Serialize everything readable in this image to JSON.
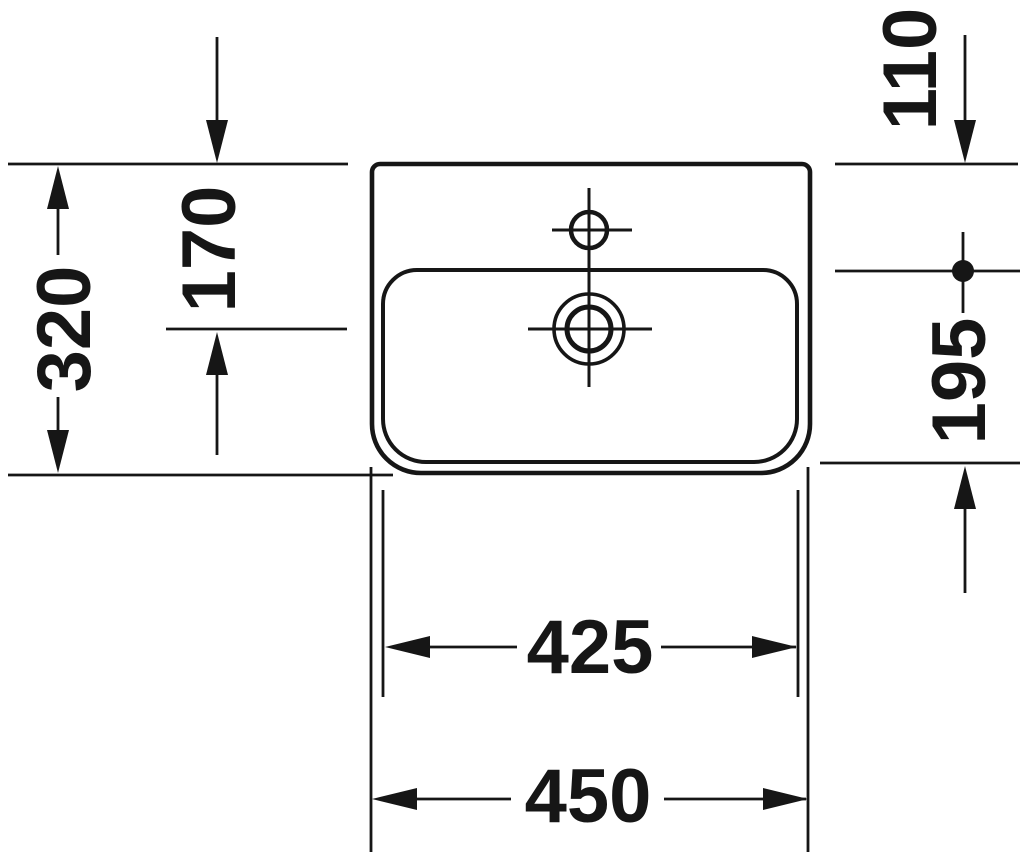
{
  "figure": {
    "kind": "washbasin-technical-drawing-top-view",
    "background_color": "#ffffff",
    "line_color": "#161616"
  },
  "dimensions": [
    {
      "id": "overall-depth-left",
      "value": "320",
      "orientation": "vertical"
    },
    {
      "id": "inner-depth-left",
      "value": "170",
      "orientation": "vertical"
    },
    {
      "id": "rear-offset-top-right",
      "value": "110",
      "orientation": "vertical"
    },
    {
      "id": "bowl-depth-right",
      "value": "195",
      "orientation": "vertical"
    },
    {
      "id": "bowl-width-bottom",
      "value": "425",
      "orientation": "horizontal"
    },
    {
      "id": "overall-width-bottom",
      "value": "450",
      "orientation": "horizontal"
    }
  ]
}
